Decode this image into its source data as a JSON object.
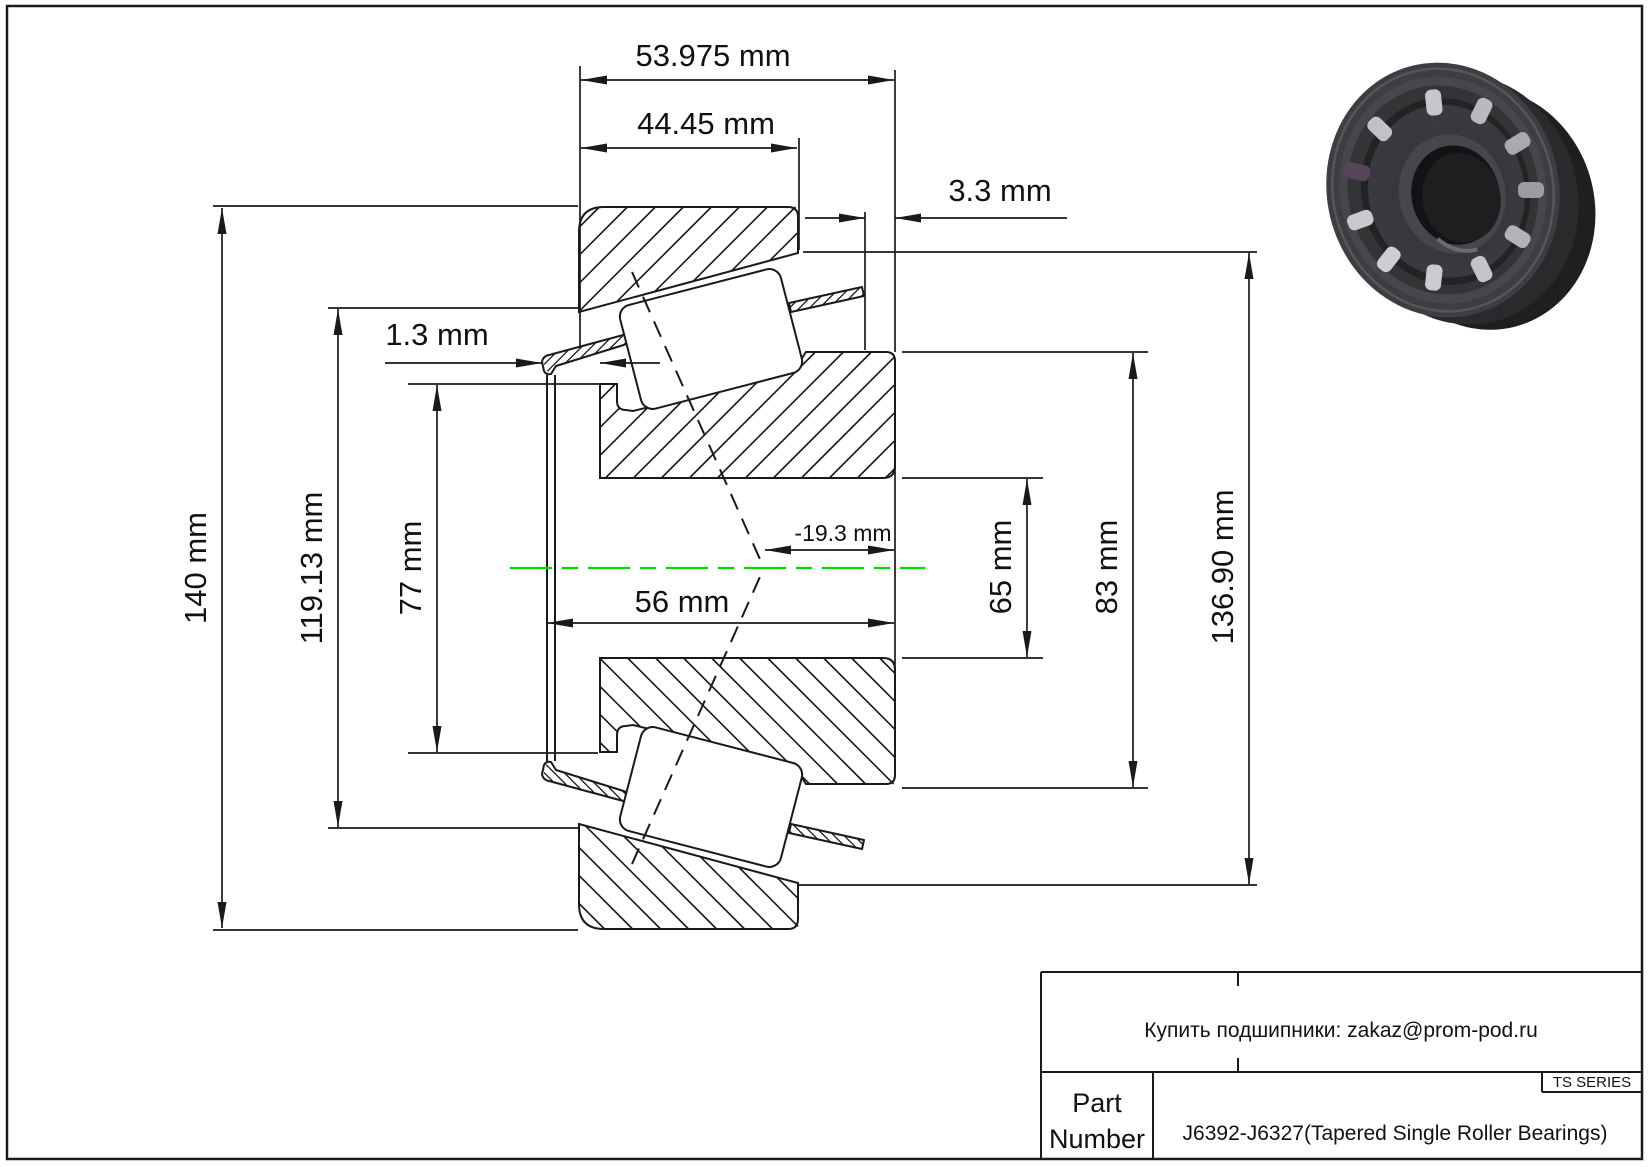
{
  "drawing": {
    "dim_total_width": "53.975 mm",
    "dim_cup_width": "44.45 mm",
    "dim_cup_standout": "3.3 mm",
    "dim_flinger_offset": "1.3 mm",
    "dim_outer_diameter": "140 mm",
    "dim_cup_front_inner_diameter": "119.13 mm",
    "dim_cone_rib_diameter": "77 mm",
    "dim_cone_width": "56 mm",
    "dim_effective_center": "-19.3 mm",
    "dim_bore_diameter": "65 mm",
    "dim_cone_back_diameter": "83 mm",
    "dim_cup_back_inner_diameter": "136.90 mm"
  },
  "title_block": {
    "contact": "Купить подшипники: zakaz@prom-pod.ru",
    "series": "TS SERIES",
    "part_label_line1": "Part",
    "part_label_line2": "Number",
    "part_number": "J6392-J6327(Tapered Single Roller Bearings)"
  },
  "colors": {
    "line": "#1a1a1a",
    "centerline": "#00d900",
    "background": "#ffffff"
  }
}
